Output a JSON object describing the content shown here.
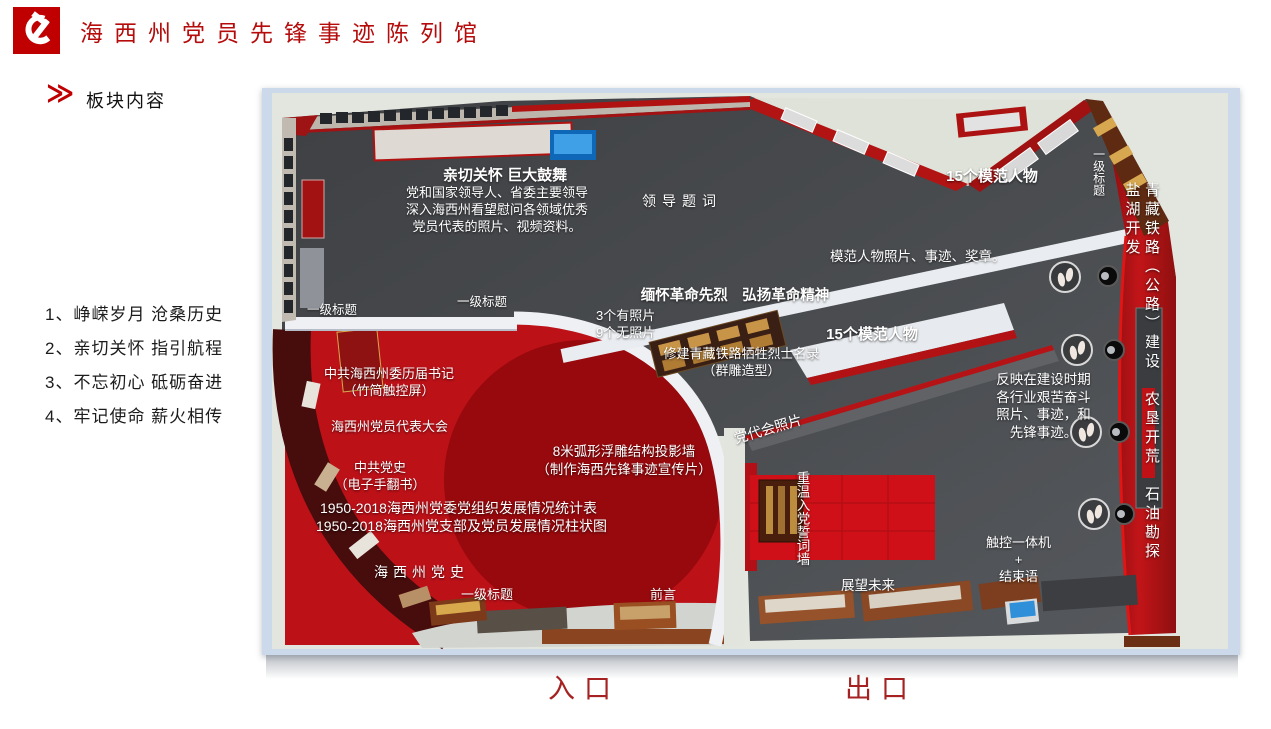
{
  "header": {
    "title": "海西州党员先锋事迹陈列馆"
  },
  "section": {
    "heading": "板块内容"
  },
  "icons": {
    "double_chevron": "≫"
  },
  "list": {
    "items": [
      "1、峥嵘岁月  沧桑历史",
      "2、亲切关怀  指引航程",
      "3、不忘初心  砥砺奋进",
      "4、牢记使命  薪火相传"
    ]
  },
  "plan": {
    "labels": {
      "care_title": "亲切关怀 巨大鼓舞",
      "care_desc": "党和国家领导人、省委主要领导\n深入海西州看望慰问各领域优秀\n党员代表的照片、视频资料。",
      "leader_inscription": "领导题词",
      "model_figures_top": "15个模范人物",
      "level1_title_right": "一级标题",
      "railway_vertical": "青藏铁路（公路）建设　农垦开荒　石油勘探　盐湖开发",
      "model_photos": "模范人物照片、事迹、奖章。",
      "martyrs_title": "缅怀革命先烈　弘扬革命精神",
      "photos_count": "3个有照片\n9个无照片",
      "memorial": "修建青藏铁路牺牲烈士名录\n（群雕造型）",
      "model_figures_mid": "15个模范人物",
      "level1_title_left": "一级标题",
      "level1_title_mid": "一级标题",
      "secretaries": "中共海西州委历届书记\n（竹简触控屏）",
      "congress": "海西州党员代表大会",
      "construction": "反映在建设时期\n各行业艰苦奋斗\n照片、事迹，和\n先锋事迹。",
      "party_history": "中共党史\n（电子手翻书）",
      "stat_table": "1950-2018海西州党委党组织发展情况统计表",
      "stat_chart": "1950-2018海西州党支部及党员发展情况柱状图",
      "projection_wall": "8米弧形浮雕结构投影墙\n（制作海西先锋事迹宣传片）",
      "haixi_history": "海西州党史",
      "level1_title_bottom": "一级标题",
      "preface": "前言",
      "congress_photos": "党代会照片",
      "oath_wall": "重温入党誓词墙",
      "future": "展望未来",
      "touch_machine": "触控一体机\n+\n结束语"
    },
    "entrance": "入口",
    "exit": "出口"
  },
  "colors": {
    "title_red": "#b50b0b",
    "accent_red": "#c00000",
    "wall_red": "#b21414",
    "carpet_red": "#bd1118",
    "floor_gray": "#47494c",
    "frame_blue": "#ccd9ea"
  }
}
